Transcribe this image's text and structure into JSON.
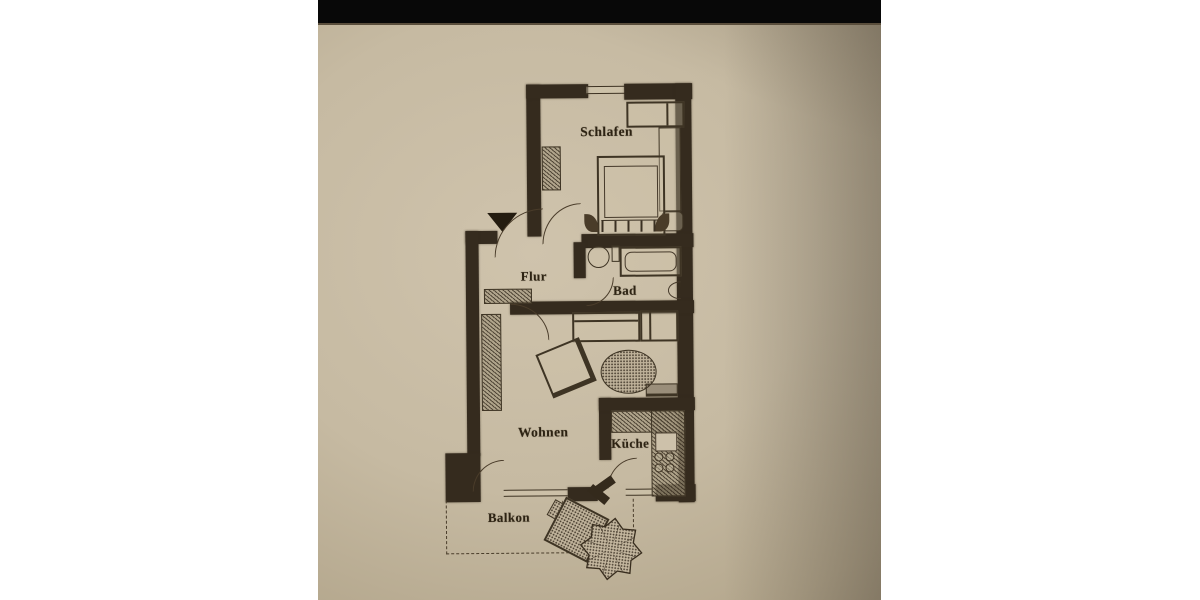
{
  "scene": {
    "type": "photographed architectural floor plan on beige paper",
    "page_background": "#ffffff",
    "paper_color": "#c6baa2",
    "ink_color": "#352b1e",
    "photo_top_bar_color": "#080808"
  },
  "rooms": [
    {
      "id": "schlafen",
      "label": "Schlafen"
    },
    {
      "id": "flur",
      "label": "Flur"
    },
    {
      "id": "bad",
      "label": "Bad"
    },
    {
      "id": "wohnen",
      "label": "Wohnen"
    },
    {
      "id": "kueche",
      "label": "Küche"
    },
    {
      "id": "balkon",
      "label": "Balkon"
    }
  ],
  "icons": {
    "entrance_arrow": "triangle-down"
  }
}
